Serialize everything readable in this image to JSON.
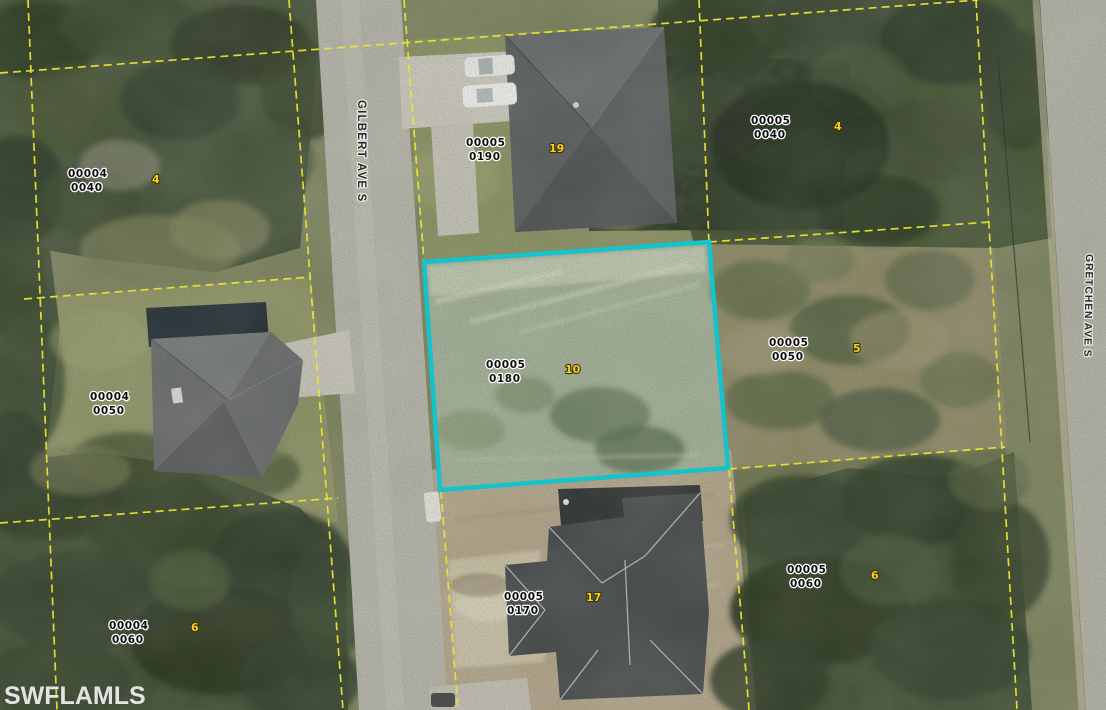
{
  "map": {
    "watermark": "SWFLAMLS",
    "streets": [
      {
        "name": "GILBERT AVE S"
      },
      {
        "name": "GRETCHEN AVE S"
      }
    ],
    "colors": {
      "highlight": "#14c3cb",
      "parcel_lines": "#e9e432",
      "lot_number": "#f2cf2a"
    },
    "parcels": [
      {
        "book": "00004",
        "page": "0040",
        "lot": "4"
      },
      {
        "book": "00005",
        "page": "0190",
        "lot": "19"
      },
      {
        "book": "00005",
        "page": "0040",
        "lot": "4"
      },
      {
        "book": "00004",
        "page": "0050"
      },
      {
        "book": "00005",
        "page": "0180",
        "lot": "10",
        "selected": true
      },
      {
        "book": "00005",
        "page": "0050",
        "lot": "5"
      },
      {
        "book": "00004",
        "page": "0060",
        "lot": "6"
      },
      {
        "book": "00005",
        "page": "0170",
        "lot": "17"
      },
      {
        "book": "00005",
        "page": "0060",
        "lot": "6"
      }
    ]
  }
}
